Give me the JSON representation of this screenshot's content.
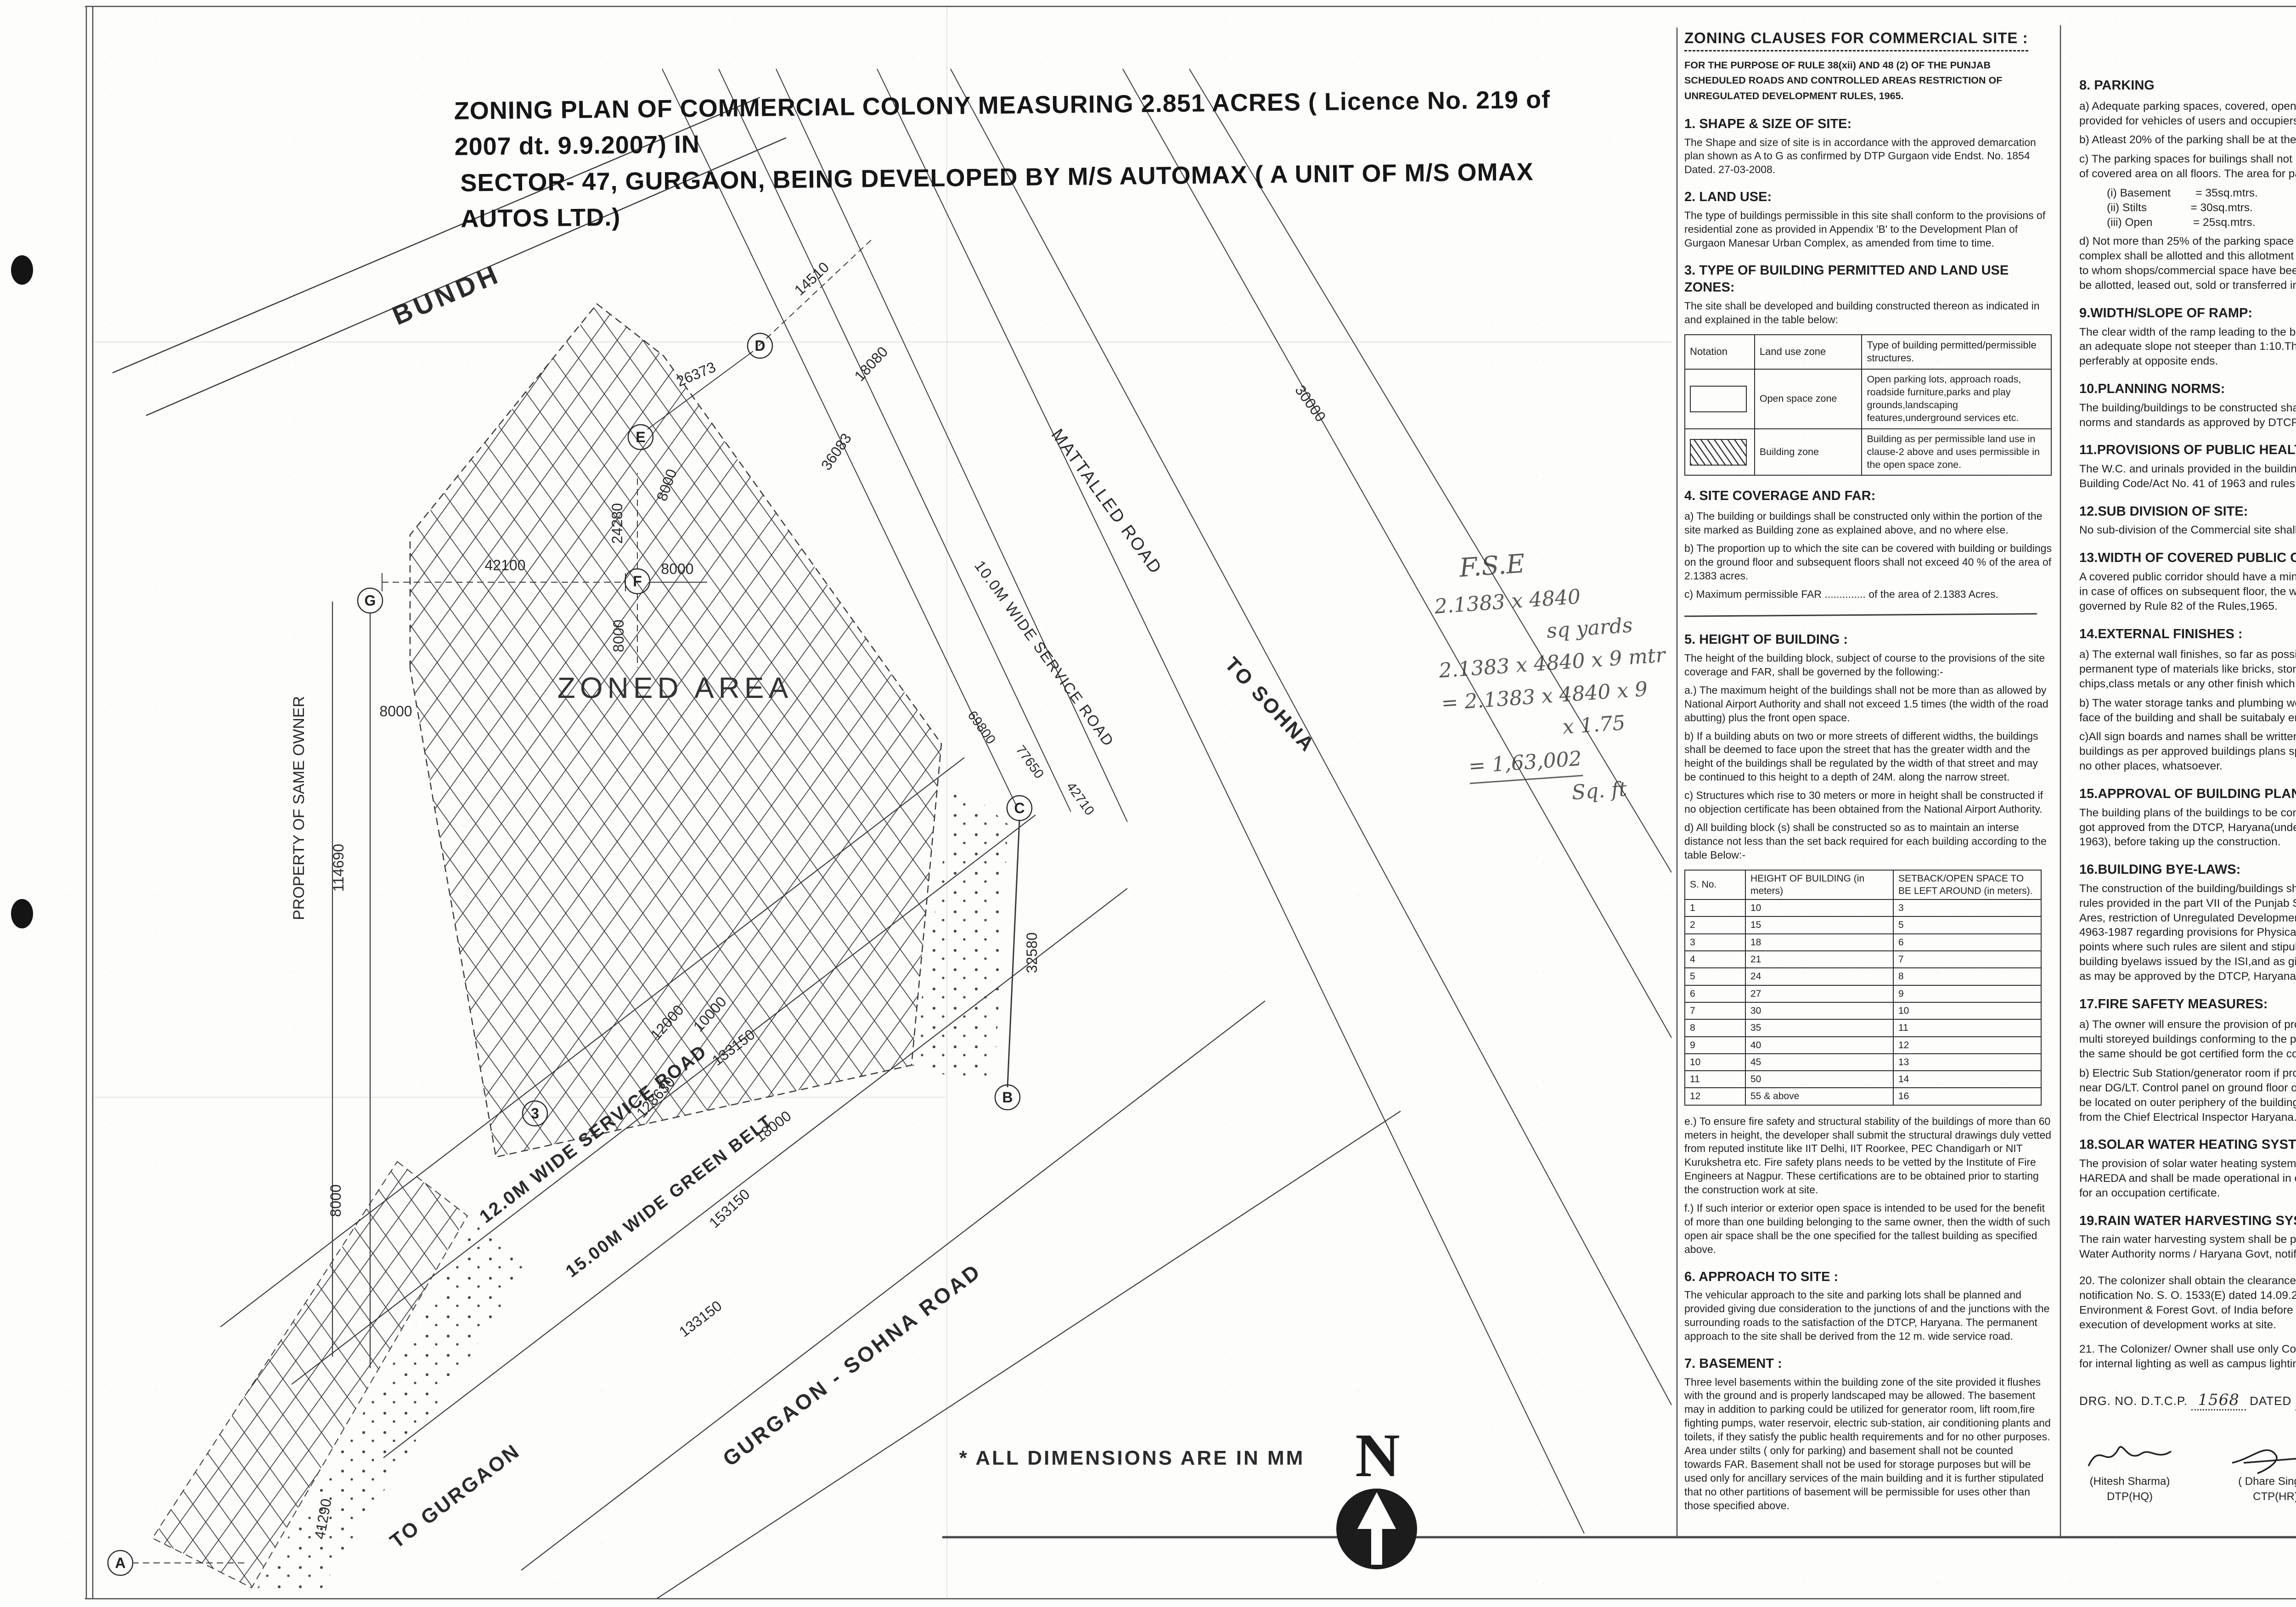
{
  "title": {
    "line1": "ZONING PLAN OF COMMERCIAL COLONY  MEASURING 2.851 ACRES ( Licence No. 219 of 2007 dt. 9.9.2007) IN",
    "line2": "SECTOR- 47, GURGAON, BEING DEVELOPED BY M/S AUTOMAX ( A UNIT OF M/S OMAX AUTOS LTD.)"
  },
  "plan": {
    "area_label": "ZONED AREA",
    "bundh": "BUNDH",
    "property_owner": "PROPERTY OF SAME OWNER",
    "note": "*  ALL DIMENSIONS ARE IN MM",
    "north_letter": "N",
    "roads": {
      "service12": "12.0M WIDE SERVICE ROAD",
      "green15": "15.00M WIDE GREEN BELT",
      "sohna": "GURGAON - SOHNA ROAD",
      "service10": "10.0M WIDE SERVICE ROAD",
      "mattalled": "MATTALLED ROAD",
      "to_sohna": "TO SOHNA",
      "to_gurgaon": "TO GURGAON"
    },
    "dims": {
      "d26373": "26373",
      "d14510": "14510",
      "d18080": "18080",
      "d36083": "36083",
      "d30000": "30000",
      "d24280": "24280",
      "d42100": "42100",
      "d8000": "8000",
      "d114690": "114690",
      "d128630": "128630",
      "d10000": "10000",
      "d12000": "12000",
      "d153150": "153150",
      "d32580": "32580",
      "d133150": "133150",
      "d18000": "18000",
      "d41290": "41290",
      "d69800": "69800",
      "d77650": "77650",
      "d42710": "42710"
    },
    "points": {
      "A": "A",
      "B": "B",
      "C": "C",
      "D": "D",
      "E": "E",
      "F": "F",
      "G": "G",
      "n3": "3"
    },
    "handwriting": {
      "l1": "F.S.E",
      "l2": "2.1383 x 4840",
      "l2b": "sq yards",
      "l3": "2.1383 x 4840 x 9 mtr",
      "l4": "= 2.1383 x 4840 x 9",
      "l4b": "x 1.75",
      "l5": "= 1,63,002",
      "l5b": "Sq. ft"
    }
  },
  "clauses": {
    "header": "ZONING CLAUSES FOR COMMERCIAL SITE :",
    "rule_note": "FOR THE PURPOSE OF RULE 38(xii) AND 48 (2) OF THE PUNJAB SCHEDULED ROADS AND CONTROLLED AREAS RESTRICTION OF UNREGULATED DEVELOPMENT RULES, 1965.",
    "s1": {
      "h": "1. SHAPE & SIZE OF SITE:",
      "p": "The Shape and size of site is in accordance with the  approved demarcation plan shown as A to G as  confirmed by DTP Gurgaon vide  Endst. No. 1854 Dated. 27-03-2008."
    },
    "s2": {
      "h": "2. LAND USE:",
      "p": "The type of buildings permissible in this site shall  conform to the provisions of residential zone as  provided in Appendix 'B' to the Development Plan of Gurgaon Manesar Urban Complex, as amended from time  to time."
    },
    "s3": {
      "h": "3. TYPE OF BUILDING PERMITTED AND LAND USE ZONES:",
      "p": "The site shall be developed  and building constructed thereon as indicated in and explained in the table below:",
      "t1": {
        "h_notation": "Notation",
        "h_zone": "Land use zone",
        "h_type": "Type of building permitted/permissible structures.",
        "r1_zone": "Open space zone",
        "r1_type": "Open parking lots, approach roads, roadside furniture,parks and play grounds,landscaping features,underground services etc.",
        "r2_zone": "Building zone",
        "r2_type": "Building as per permissible land use in clause-2  above and uses permissible in the open space zone."
      }
    },
    "s4": {
      "h": "4. SITE COVERAGE AND FAR:",
      "a": "a) The building or buildings shall be constructed only  within the portion of the site marked as Building zone as explained above, and no where else.",
      "b": "b) The proportion up to which the site can be covered  with building or buildings on the ground floor and subsequent floors shall not exceed 40 % of the area of 2.1383 acres.",
      "c": "c) Maximum permissible FAR ..............  of the area of 2.1383 Acres."
    },
    "s5": {
      "h": "5. HEIGHT OF BUILDING :",
      "p": "The height of the building block, subject of course to the provisions of the site coverage  and FAR, shall be governed by the following:-",
      "a": "a.) The maximum height of the buildings shall not be more than as allowed by National Airport  Authority and shall not exceed  1.5 times (the width of the road abutting) plus the front open space.",
      "b": "b) If a building abuts on two or more streets of  different widths, the buildings shall be deemed to face  upon the street that has the greater width and the height of the buildings shall be regulated by the width  of that street and may be continued to this height to a  depth of 24M. along the narrow street.",
      "c": "c) Structures which rise to 30 meters or more in height  shall be constructed if no objection certificate has  been obtained from the National Airport Authority.",
      "d": "d) All building block (s) shall be constructed so as to  maintain an interse distance not less than the set back  required for each building according to the table  Below:-",
      "t2": {
        "h_sno": "S. No.",
        "h_height": "HEIGHT OF BUILDING (in meters)",
        "h_setback": "SETBACK/OPEN SPACE TO BE LEFT AROUND (in meters).",
        "rows": [
          {
            "sno": "1",
            "height": "10",
            "setback": "3"
          },
          {
            "sno": "2",
            "height": "15",
            "setback": "5"
          },
          {
            "sno": "3",
            "height": "18",
            "setback": "6"
          },
          {
            "sno": "4",
            "height": "21",
            "setback": "7"
          },
          {
            "sno": "5",
            "height": "24",
            "setback": "8"
          },
          {
            "sno": "6",
            "height": "27",
            "setback": "9"
          },
          {
            "sno": "7",
            "height": "30",
            "setback": "10"
          },
          {
            "sno": "8",
            "height": "35",
            "setback": "11"
          },
          {
            "sno": "9",
            "height": "40",
            "setback": "12"
          },
          {
            "sno": "10",
            "height": "45",
            "setback": "13"
          },
          {
            "sno": "11",
            "height": "50",
            "setback": "14"
          },
          {
            "sno": "12",
            "height": "55 & above",
            "setback": "16"
          }
        ]
      },
      "e": "e.) To ensure fire safety and structural stability of the buildings of more than 60 meters  in height, the developer shall submit the structural drawings duly vetted from reputed institute like IIT Delhi, IIT Roorkee, PEC Chandigarh or NIT Kurukshetra etc. Fire safety plans needs to be vetted by the Institute of Fire Engineers at Nagpur. These certifications are to be obtained prior to starting the construction work at site.",
      "f": "f.) If such interior or exterior open space is intended to  be used for the  benefit of more than one building  belonging to the same owner, then the  width of such open air space shall be the one specified for the  tallest  building as specified above."
    },
    "s6": {
      "h": "6. APPROACH TO SITE :",
      "p": "The vehicular approach to the site and parking lots  shall be planned and  provided giving due consideration  to the junctions of and the junctions with  the  surrounding roads to the satisfaction of the DTCP,  Haryana. The  permanent approach to the site shall be  derived from the 12 m. wide  service road."
    },
    "s7": {
      "h": "7. BASEMENT :",
      "p": "Three level basements within the building zone of the  site provided it  flushes with the ground and is properly  landscaped may be allowed. The basement may in  addition to parking could be utilized for generator room, lift room,fire fighting pumps, water reservoir, electric  sub-station, air conditioning plants and toilets, if they  satisfy the public health requirements and for no other  purposes. Area under stilts ( only for parking) and basement shall not be counted towards FAR. Basement  shall not be used for storage purposes but will be used  only for ancillary services of the main building and it  is further stipulated that no other partitions of  basement will be permissible for uses other than those  specified above."
    },
    "s8": {
      "h": "8. PARKING",
      "a": "a)  Adequate parking spaces, covered, open or in the basement shall be provided for vehicles of users and occupiers, within the site.",
      "b": "b)   Atleast 20% of the parking shall be at the street level.",
      "c": "c)   The parking spaces for builings shall not be less than 1P.C.U.for 75 sq.mt. of covered area on all floors. The area for parking per car shall be as under:-",
      "rows": [
        {
          "label": "(i)   Basement",
          "value": "=   35sq.mtrs."
        },
        {
          "label": "(ii)  Stilts",
          "value": "=   30sq.mtrs."
        },
        {
          "label": "(iii) Open",
          "value": "=   25sq.mtrs."
        }
      ],
      "d": "d) Not more than 25% of the parking space with in the shopping/commercial complex shall be allotted and this allotment shall be made only to the persons to whom shops/commercial space have been allotted. No parking space shall be allotted, leased out, sold or transferred in any manner to any third party."
    },
    "s9": {
      "h": "9.WIDTH/SLOPE OF RAMP:",
      "p": "The clear width of the ramp leading to the basement floor shall be 4 mtrs. with an adequate slope not steeper than 1:10.The entery and exit shall be seperate perferably at opposite ends."
    },
    "s10": {
      "h": "10.PLANNING NORMS:",
      "p": "The building/buildings to be constructed shall be planned and designed to the norms and standards as approved by DTCP, Haryana."
    },
    "s11": {
      "h": "11.PROVISIONS OF PUBLIC HEALTH FACILITIES:",
      "p": "The W.C. and urinals provided in the buildings shall conform to the National Building Code/Act No. 41 of 1963 and rules framed there under."
    },
    "s12": {
      "h": "12.SUB DIVISION OF SITE:",
      "p": "No sub-division of the Commercial site shall be permitted."
    },
    "s13": {
      "h": "13.WIDTH OF COVERED PUBLIC CORRIDOR:",
      "p": "A covered public corridor should have a minimum clear width of 8'-3\". However in case of offices on subsequent floor, the width of the corridor would be governed by Rule 82 of the Rules,1965."
    },
    "s14": {
      "h": "14.EXTERNAL FINISHES :",
      "a": "a) The external wall finishes, so far as possible shall be in natural or permanent type of materials like bricks, stone,concrete,terracotta,grits, marble, chips,class metals or any other finish which may be allowed by the DTCP.",
      "b": "b) The water storage tanks and plumbing works shall not be visible on any face of the building and shall be suitabaly encased.",
      "c": "c)All sign boards and names shall be written on the spaces provided on buildings as per approved buildings plans specifically for this purpose and at no other places, whatsoever."
    },
    "s15": {
      "h": "15.APPROVAL OF BUILDING PLANS:",
      "p": "The building plans of the buildings to be constructed at site shall have to be got approved from the DTCP, Haryana(under section 8(2) of the Act No.41 of 1963), before taking up the construction."
    },
    "s16": {
      "h": "16.BUILDING BYE-LAWS:",
      "p": "The construction of the building/buildings shall be governed by the building rules provided in the part VII of the Punjab Scheduled Roads and Controlled Ares, restriction of Unregulated Development Rules, 1965 and IS Code No. 4963-1987 regarding provisions for Physically Handicapped Persons. On the points where such rules are silent and stipulate no condition or norm,the model building byelaws issued by the ISI,and as given in the NBC shall be followed as may be approved by the DTCP, Haryana."
    },
    "s17": {
      "h": "17.FIRE SAFETY MEASURES:",
      "a": "a) The owner will ensure the provision of proper fire safety measures in the multi storeyed buildings conforming to the provisions of Rules 1965/NBC and the same should be got certified form the competent authority.",
      "b": "b) Electric Sub Station/generator room if provided should be on solid ground near DG/LT. Control panel on ground floor or in upper basement and it should be located on outer periphery of the building,the same should be got approved from the Chief Electrical Inspector Haryana."
    },
    "s18": {
      "h": "18.SOLAR WATER HEATING SYSTEM",
      "p": "The provision of solar water heating system shall be as per norms specified by HAREDA and shall be made operational in each building block before applying for an occupation certificate."
    },
    "s19": {
      "h": "19.RAIN WATER HARVESTING SYSTEM.",
      "p": "The rain water harvesting system shall be provided as per Central Ground Water Authority norms / Haryana Govt, notification as applicable."
    },
    "s20": {
      "p": "20. The colonizer shall obtain the clearance/NOC as per the provisions of the notification No. S. O. 1533(E) dated 14.09.2006 issued by Ministry of Environment & Forest Govt. of India before starting the construction / execution of development works at site."
    },
    "s21": {
      "p": "21. The Colonizer/ Owner shall use only Compact Fluorescent Lamps fittings for internal lighting as well as campus lighting."
    }
  },
  "footer": {
    "drg_prefix": "DRG. NO.  D.T.C.P.",
    "drg_no": "1568",
    "dated_label": "DATED",
    "drg_date": "16.4.08",
    "signatures": [
      {
        "name": "(Hitesh Sharma)",
        "title": "DTP(HQ)"
      },
      {
        "name": "( Dhare Singh )",
        "title": "CTP(HR)"
      },
      {
        "name": "( S.S.Dhillon )",
        "title": "D.T.C.P(HR)"
      }
    ]
  }
}
